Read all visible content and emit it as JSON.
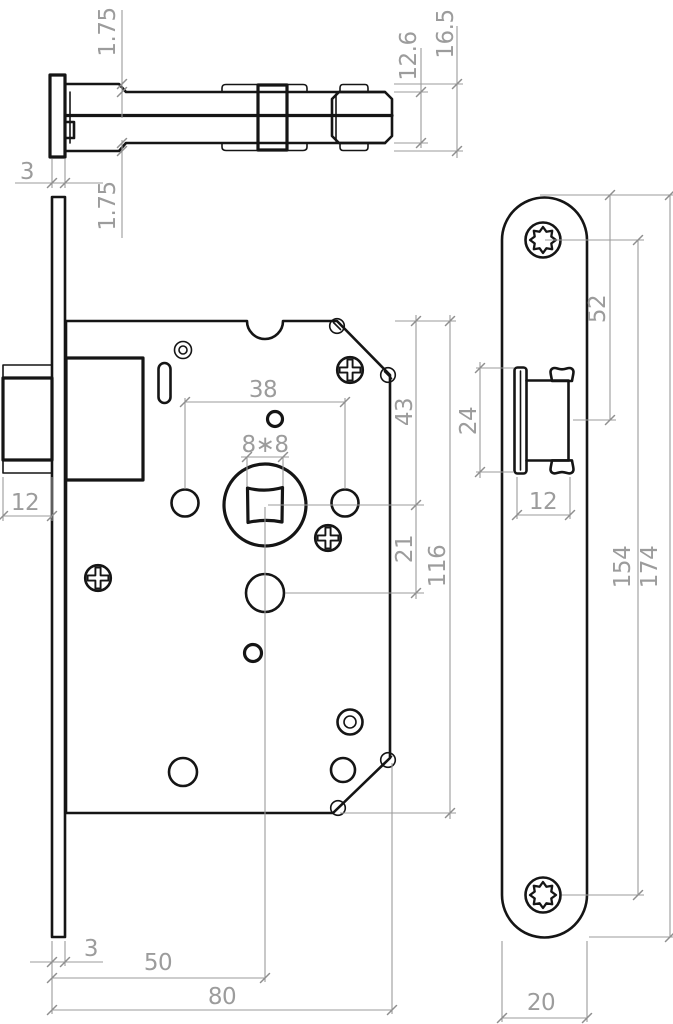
{
  "drawing": {
    "type": "technical-drawing",
    "subject": "mortise-lock",
    "units": "mm",
    "colors": {
      "outline": "#151515",
      "dimension": "#9b9b9b",
      "background": "#ffffff"
    }
  },
  "dims": {
    "side_plate_thickness": "3",
    "side_top_plate": "1.75",
    "side_bottom_plate": "1.75",
    "side_inner_height": "12.6",
    "side_outer_height": "16.5",
    "front_latch_protrusion": "12",
    "front_hole_spacing": "38",
    "front_spindle": "8∗8",
    "front_top_to_spindle": "43",
    "front_spindle_to_cylinder": "21",
    "front_case_height": "116",
    "front_plate_thickness": "3",
    "front_backset": "50",
    "front_case_depth": "80",
    "plate_top_to_latch": "52",
    "plate_latch_height": "24",
    "plate_latch_width": "12",
    "plate_screw_spacing": "154",
    "plate_length": "174",
    "plate_width": "20"
  }
}
